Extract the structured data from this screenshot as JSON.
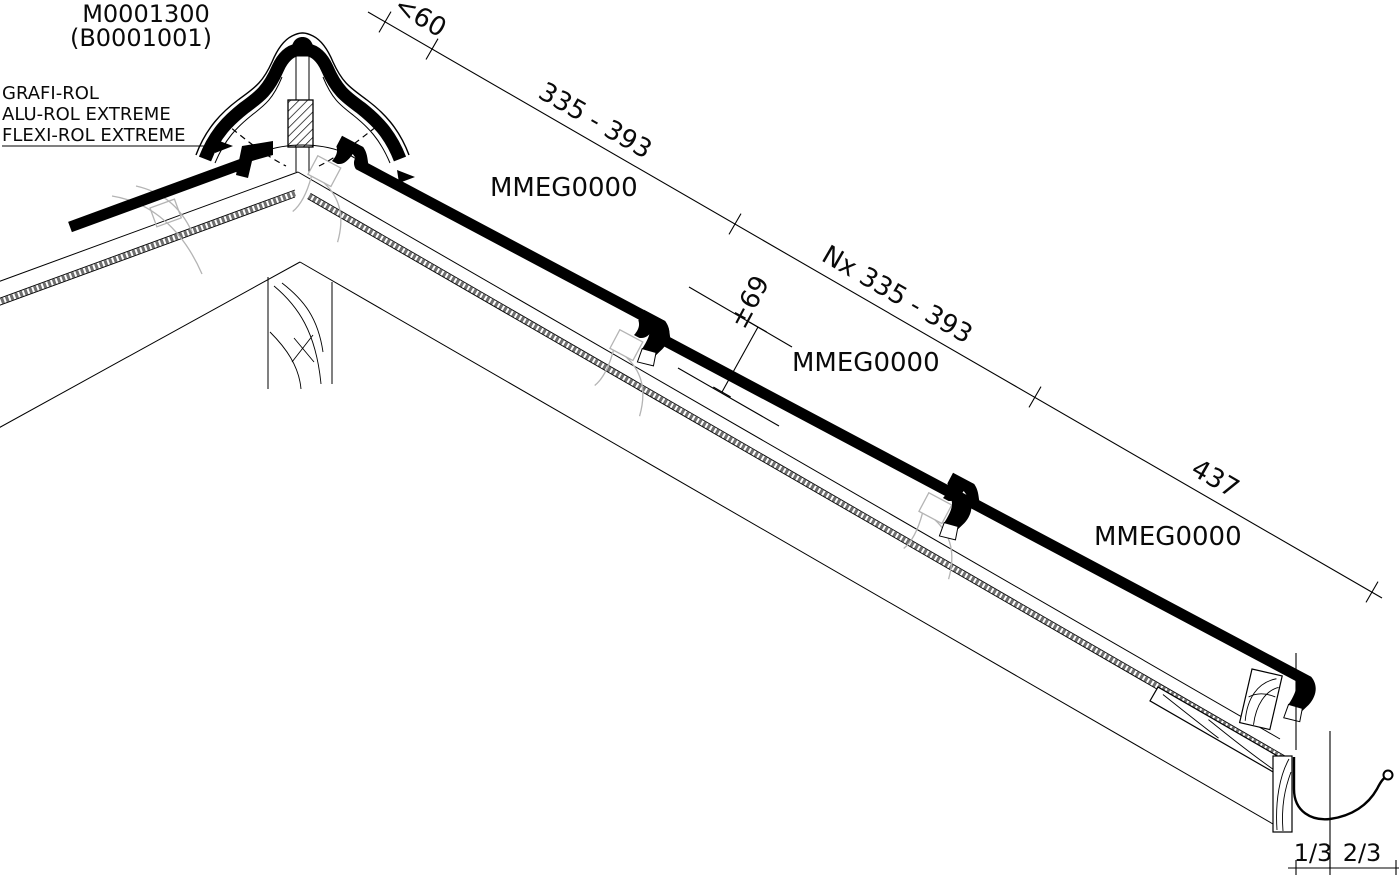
{
  "drawing": {
    "title": "M0001300",
    "subtitle": "(B0001001)",
    "underlay_products": [
      "GRAFI-ROL",
      "ALU-ROL EXTREME",
      "FLEXI-ROL EXTREME"
    ],
    "tile_code": "MMEG0000",
    "dims": {
      "ridge_offset": "<60",
      "first_course": "335 - 393",
      "repeat_courses": "Nx 335 - 393",
      "eave_course": "437",
      "head_lap": "±69",
      "gutter_front_fraction": "1/3",
      "gutter_back_fraction": "2/3"
    }
  },
  "colors": {
    "ink": "#000000",
    "paper": "#ffffff",
    "ghost_lines": "#b4b4b4",
    "membrane": "#6f6f6f"
  }
}
